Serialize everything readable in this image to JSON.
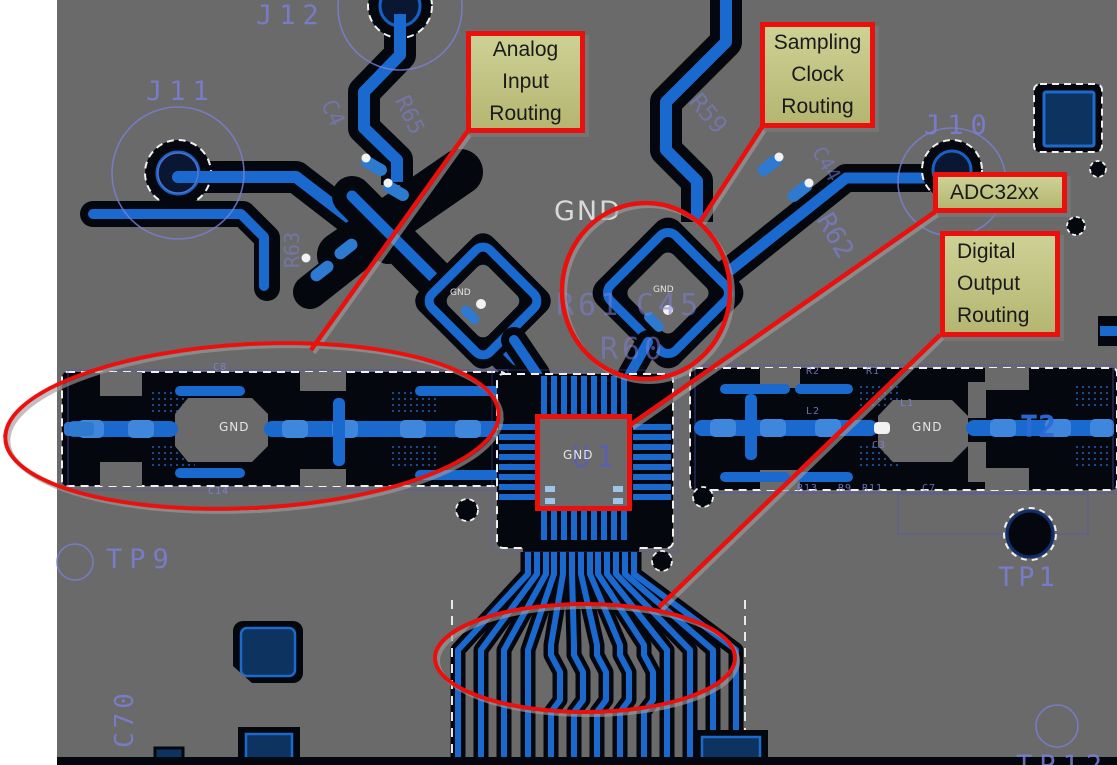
{
  "annotations": {
    "analog_input_label": "Analog\nInput\nRouting",
    "sampling_clock_label": "Sampling\nClock\nRouting",
    "adc_label": "ADC32xx",
    "digital_output_label": "Digital\nOutput\nRouting"
  },
  "copper_text": {
    "gnd_plane_top": "GND",
    "gnd_left_island": "GND",
    "gnd_right_island": "GND",
    "gnd_chip": "GND",
    "gnd_analog_component": "GND",
    "gnd_clock_component": "GND"
  },
  "silkscreen": {
    "j11": "J11",
    "j12": "J12",
    "j10": "J10",
    "tp9": "TP9",
    "tp1": "TP1",
    "tp12": "TP12",
    "u1": "U1",
    "t2": "T2",
    "c70": "C70",
    "r59": "R59",
    "r62": "R62",
    "r63": "R63",
    "r61": "R61",
    "c45": "C45",
    "r60": "R60",
    "r65": "R65",
    "c4": "C4",
    "c44": "C44",
    "r2": "R2",
    "r1": "R1",
    "l2": "L2",
    "l1": "L1",
    "c3": "C3",
    "r13": "R13",
    "r9": "R9",
    "r11": "R11",
    "c7": "C7",
    "c8": "C8",
    "c14": "C14"
  },
  "colors": {
    "board_gray": "#6a6a6a",
    "copper_dark": "#04070e",
    "trace_blue": "#1a69cf",
    "pad_blue": "#3f86dd",
    "component_navy": "#0d3361",
    "silkscreen_blue": "#7b7fd6",
    "annotation_red": "#e9100d",
    "callout_fill": "#c5c887"
  }
}
